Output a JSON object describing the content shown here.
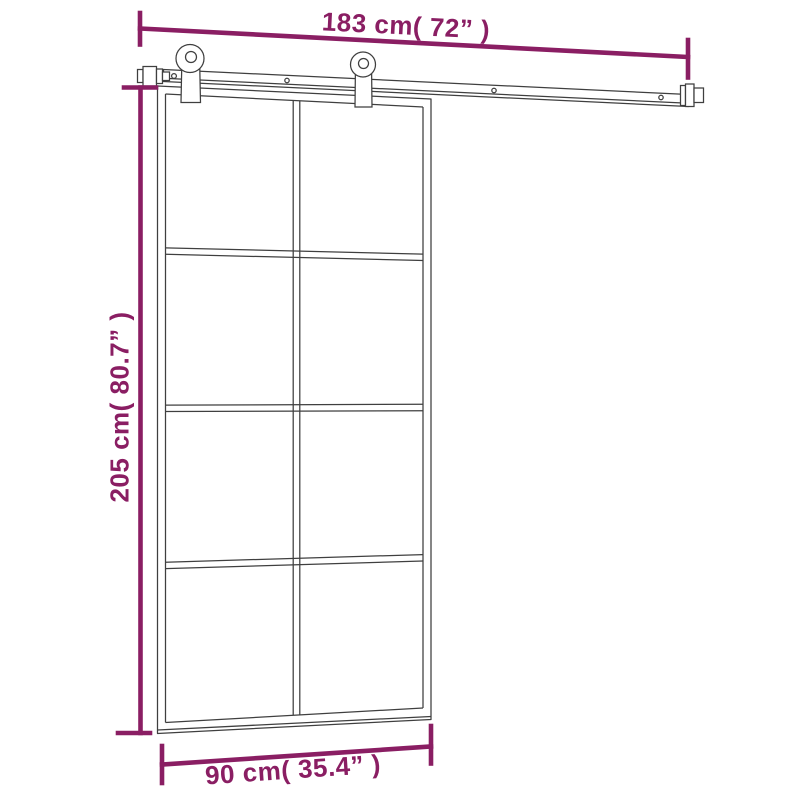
{
  "diagram": {
    "title_hidden": "",
    "colors": {
      "background": "#ffffff",
      "dimension_accent": "#8A1E63",
      "line_art": "#3f3f3f"
    },
    "dimensions": {
      "rail_width": {
        "label": "183 cm( 72” )"
      },
      "door_height": {
        "label": "205 cm( 80.7” )"
      },
      "door_width": {
        "label": "90 cm( 35.4” )"
      }
    },
    "subject": {
      "type": "sliding-door-with-hardware-kit",
      "glass_grid": {
        "columns": 2,
        "rows": 4
      },
      "rollers": 2
    }
  }
}
